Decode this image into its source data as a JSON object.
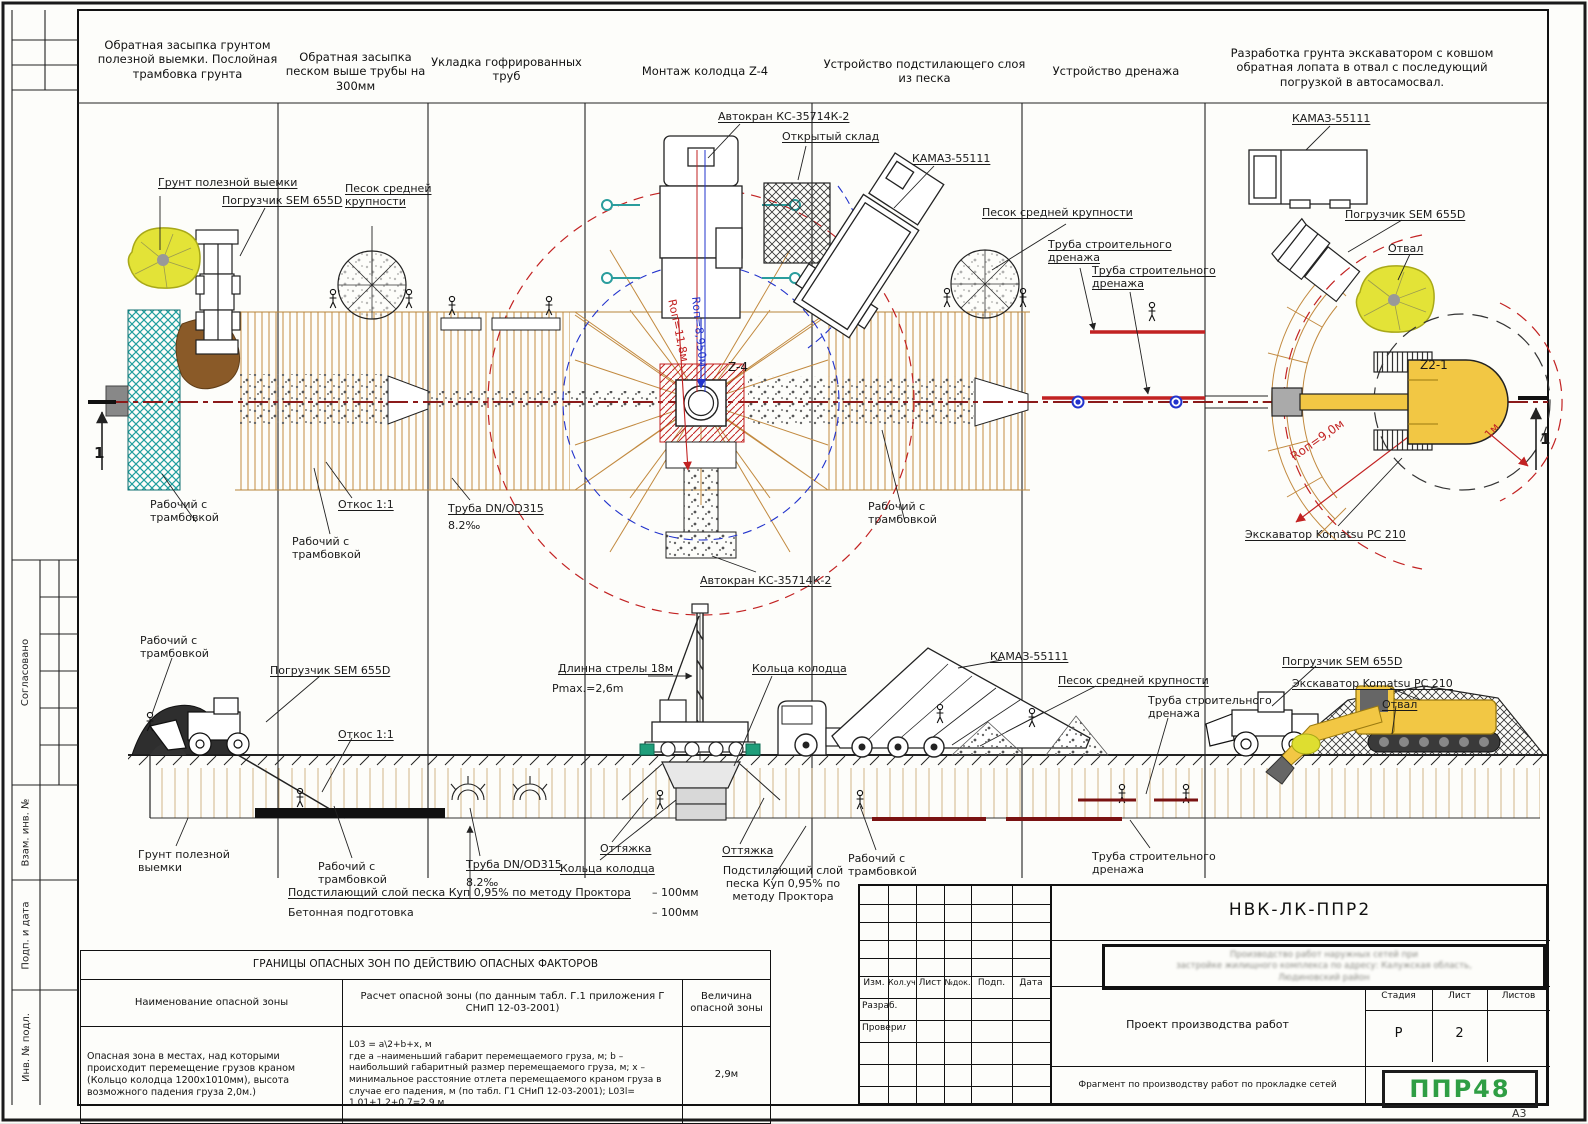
{
  "sheet": {
    "format_label": "А3"
  },
  "frame_strip": {
    "agreed": "Согласовано",
    "replace_inv": "Взам. инв. №",
    "sign_date": "Подп. и дата",
    "inv_orig": "Инв. № подл."
  },
  "headers": [
    "Обратная засыпка грунтом полезной выемки. Послойная трамбовка грунта",
    "Обратная засыпка песком выше трубы на 300мм",
    "Укладка гофрированных труб",
    "Монтаж колодца Z-4",
    "Устройство подстилающего слоя из песка",
    "Устройство дренажа",
    "Разработка грунта экскаватором с ковшом обратная лопата в отвал с последующий погрузкой в автосамосвал."
  ],
  "machines": {
    "crane": "Автокран КС-35714К-2",
    "kamaz": "КАМАЗ-55111",
    "loader": "Погрузчик SEM 655D",
    "excavator": "Экскаватор Komatsu PC 210"
  },
  "materials": {
    "soil": "Грунт полезной выемки",
    "sand": "Песок средней крупности",
    "drain_pipe": "Труба строительного дренажа",
    "pipe_dn": "Труба DN/OD315",
    "pipe_slope": "8.2‰"
  },
  "labels": {
    "worker_tamper": "Рабочий с трамбовкой",
    "slope": "Откос 1:1",
    "open_storage": "Открытый склад",
    "otval": "Отвал",
    "guy_rope": "Оттяжка",
    "well_rings": "Кольца колодца",
    "section_mark": "1"
  },
  "plan": {
    "z4": "Z-4",
    "z21": "Z2-1",
    "rop_118": "Rоп=11,8м",
    "rop_895": "Rоп=8,950м",
    "rop_9": "Rоп=9,0м",
    "one_meter": "1м"
  },
  "section": {
    "boom_length": "Длинна стрелы 18м",
    "pmax": "Pmax.=2,6m",
    "underlayment": "Подстилающий слой песка Куп 0,95% по методу Проктора",
    "underlayment_value": "– 100мм",
    "concrete_prep": "Бетонная подготовка",
    "concrete_value": "– 100мм"
  },
  "danger_table": {
    "title": "ГРАНИЦЫ ОПАСНЫХ ЗОН ПО ДЕЙСТВИЮ ОПАСНЫХ ФАКТОРОВ",
    "col_name": "Наименование опасной зоны",
    "col_calc": "Расчет опасной зоны (по данным табл. Г.1 приложения Г СНиП 12-03-2001)",
    "col_value": "Величина опасной зоны",
    "row_name": "Опасная зона в местах, над которыми происходит перемещение грузов краном (Кольцо колодца 1200х1010мм), высота возможного падения груза 2,0м.)",
    "row_calc_line1": "L03 = a\\2+b+x, м",
    "row_calc_line2": "где a –наименьший габарит перемещаемого груза, м; b – наибольший габаритный размер перемещаемого груза, м; x – минимальное расстояние отлета перемещаемого краном груза в случае его падения, м (по табл. Г1 СНиП 12-03-2001); L03l= 1,01+1,2+0,7=2,9 м",
    "row_value": "2,9м"
  },
  "title_block": {
    "code": "НВК-ЛК-ППР2",
    "col_izm": "Изм.",
    "col_koluch": "Кол.уч.",
    "col_list": "Лист",
    "col_doc": "№док.",
    "col_podp": "Подп.",
    "col_data": "Дата",
    "developed": "Разраб.",
    "checked": "Проверил",
    "project_title": "Проект производства работ",
    "stage_label": "Стадия",
    "sheet_label": "Лист",
    "sheets_label": "Листов",
    "stage_value": "Р",
    "sheet_value": "2",
    "sheets_value": "",
    "fragment": "Фрагмент по производству работ по прокладке сетей",
    "logo": "ППР48",
    "address_line1": "Производство работ наружных сетей при",
    "address_line2": "застройке жилищного комплекса по адресу: Калужская область,",
    "address_line3": "Людиновский район"
  },
  "colors": {
    "hatch_tan": "#c28a40",
    "teal": "#1f9e9e",
    "danger_red": "#c22222",
    "drain_dark_red": "#7a1212",
    "crane_blue": "#2233cc",
    "machine_yellow": "#f2c744",
    "spoil_yellow": "#e3e337",
    "logo_green": "#2f9e44"
  }
}
